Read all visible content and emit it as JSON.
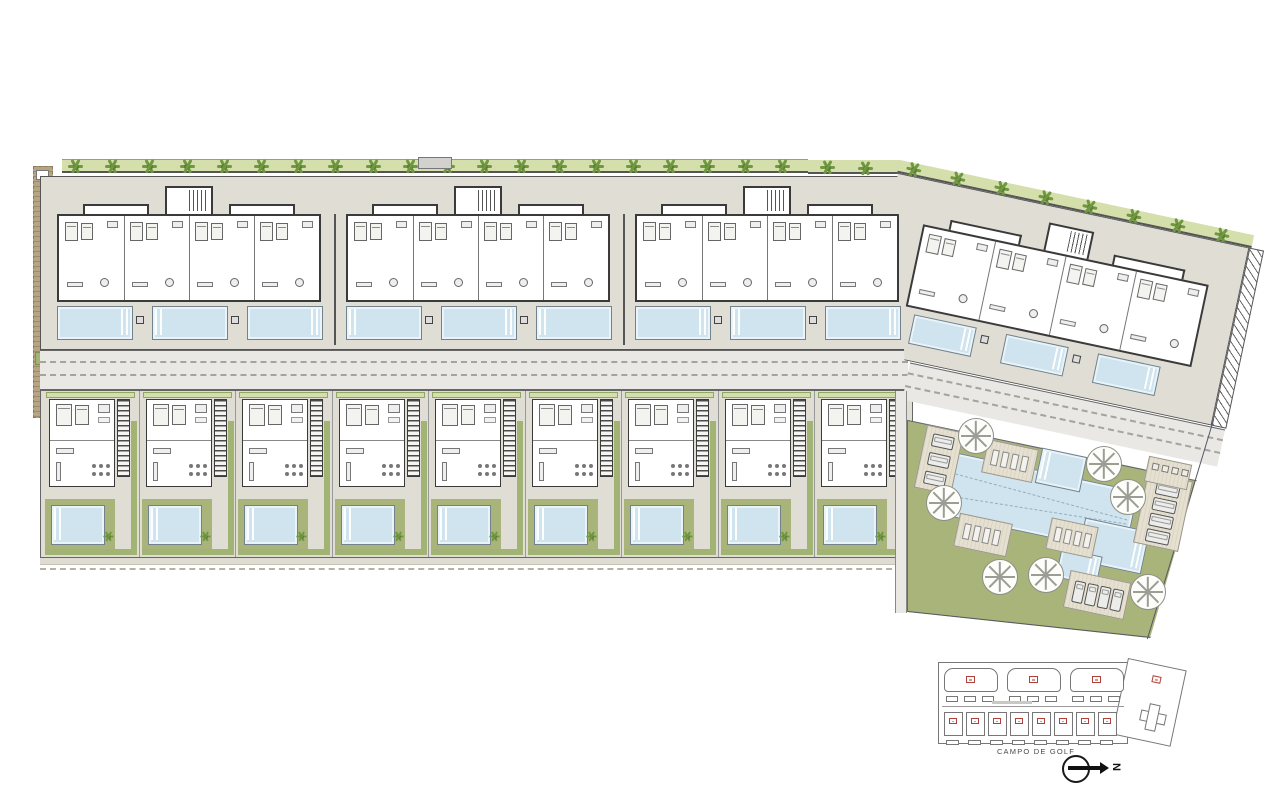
{
  "title": "Residential urbanization site plan",
  "labels": {
    "golf": "CAMPO DE GOLF",
    "north": "N"
  },
  "colors": {
    "pool": "#cfe4ef",
    "pool_border": "#72828c",
    "lawn": "#a9b47a",
    "tree": "#6f9840",
    "hedge": "#a2b473",
    "hedge_light": "#d5dfac",
    "terrace": "#e0ddd5",
    "road": "#e9e8e4",
    "wall": "#3a3a3a",
    "sand": "#b7a483",
    "marker_red": "#b04038",
    "keyplan_stroke": "#777777"
  },
  "site": {
    "apartment_blocks": 3,
    "units_per_block": 4,
    "top_row_pools": 9,
    "villas": 9,
    "right_block_pools": 3,
    "trees_top_row": 20,
    "trees_right_row": 8,
    "palm_trees": 7,
    "communal": {
      "main_pool": 1,
      "small_pools": 2,
      "lounger_pads": 3,
      "parking_pads": 3
    }
  },
  "key_plan": {
    "top_blocks": 3,
    "villa_cells": 8,
    "unit_markers_top": 3,
    "unit_markers_villas": 8,
    "rotated_wing": 1
  }
}
